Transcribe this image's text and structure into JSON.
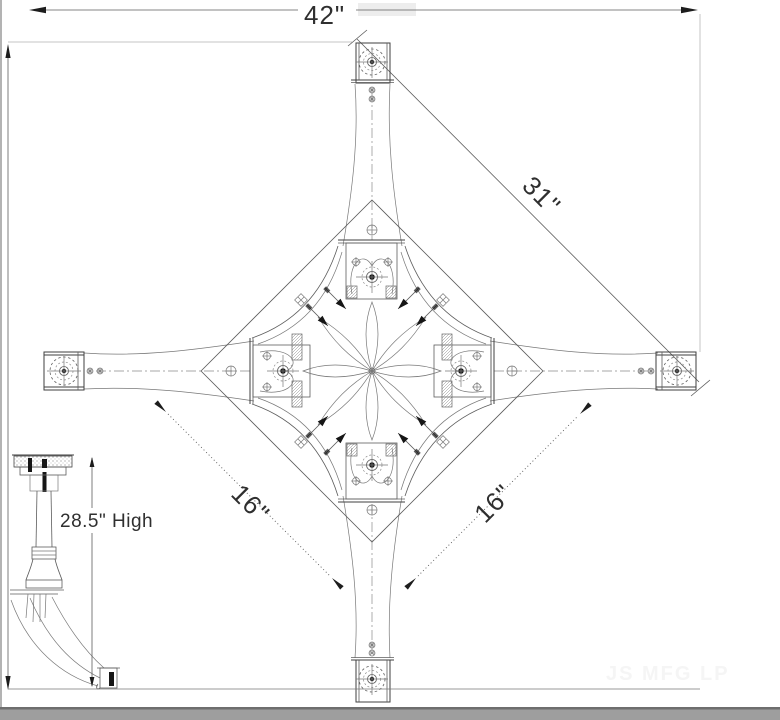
{
  "drawing": {
    "type": "furniture-cad-drawing",
    "views": {
      "plan": "table base spider and legs - top view",
      "elevation": "table base - side view"
    },
    "labels": {
      "top_width": "42\"",
      "diagonal": "31\"",
      "spider_left": "16\"",
      "spider_right": "16\"",
      "height": "28.5\" High",
      "watermark": "JS MFG LP"
    },
    "colors": {
      "paper": "#ffffff",
      "line": "#3f3f3f",
      "dim_text": "#2f2f2f",
      "faint_line": "#c6c6c6",
      "watermark": "#f5f5f5",
      "bottom_strip": "#9e9e9e",
      "bottom_strip_edge": "#6e6e6e"
    }
  }
}
